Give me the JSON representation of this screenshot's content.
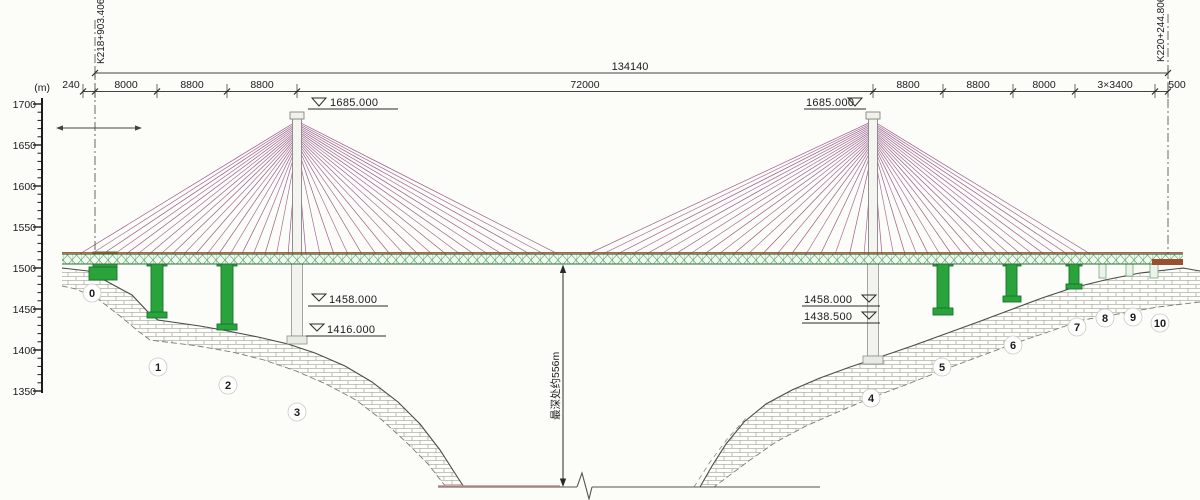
{
  "title": "cable-stayed bridge elevation drawing",
  "scale": {
    "unit": "(m)",
    "labels": [
      "1700",
      "1650",
      "1600",
      "1550",
      "1500",
      "1450",
      "1400",
      "1350"
    ]
  },
  "stations": {
    "left": "K218+903.406",
    "right": "K220+244.806"
  },
  "dims": {
    "overall": "134140",
    "segments": [
      "240",
      "8000",
      "8800",
      "8800",
      "72000",
      "8800",
      "8800",
      "8000",
      "3×3400",
      "500"
    ]
  },
  "elevations": {
    "left_tower": "1685.000",
    "right_tower": "1685.000",
    "left_mid": "1458.000",
    "left_low": "1416.000",
    "right_mid": "1458.000",
    "right_low": "1438.500"
  },
  "depth_note": "最深处约556m",
  "piers": {
    "labels": [
      "0",
      "1",
      "2",
      "3",
      "4",
      "5",
      "6",
      "7",
      "8",
      "9",
      "10"
    ]
  },
  "colors": {
    "pier_green": "#2ba33c",
    "cable_purple": "#9a5b8c",
    "deck_red": "#c0392b",
    "line": "#333333"
  }
}
